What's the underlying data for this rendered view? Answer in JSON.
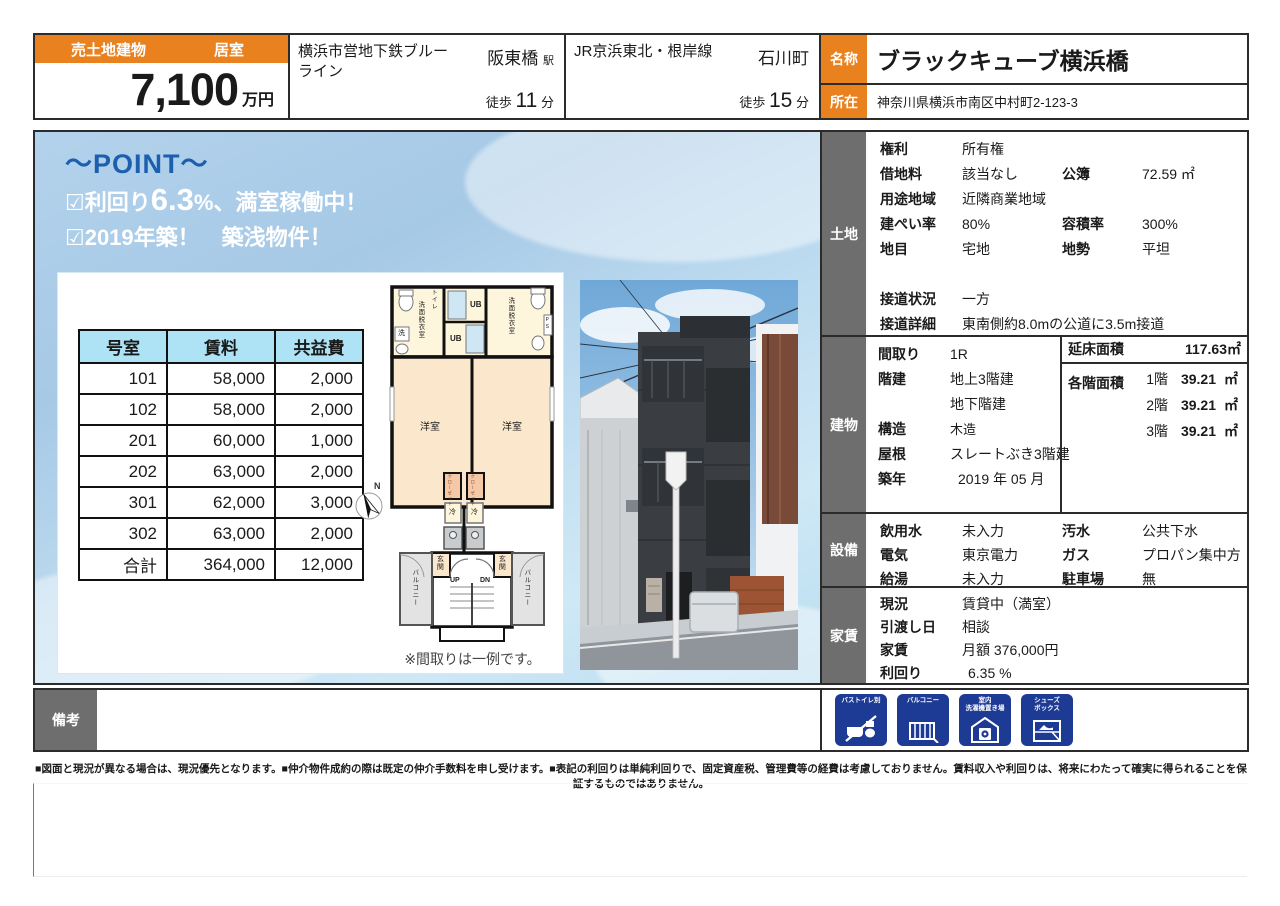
{
  "header": {
    "sale_type": "売土地建物",
    "room_type": "居室",
    "price": "7,100",
    "price_unit": "万円",
    "stations": [
      {
        "line": "横浜市営地下鉄ブルーライン",
        "station": "阪東橋",
        "suffix": "駅",
        "walk": "徒歩",
        "minutes": "11",
        "unit": "分"
      },
      {
        "line": "JR京浜東北・根岸線",
        "station": "石川町",
        "suffix": "",
        "walk": "徒歩",
        "minutes": "15",
        "unit": "分"
      }
    ],
    "name_label": "名称",
    "name": "ブラックキューブ横浜橋",
    "address_label": "所在",
    "address": "神奈川県横浜市南区中村町2-123-3"
  },
  "point": {
    "title": "～POINT～",
    "line1_pre": "☑利回り",
    "line1_big": "6.3",
    "line1_post": "%、満室稼働中！",
    "line2": "☑2019年築！　築浅物件！"
  },
  "rent_table": {
    "headers": [
      "号室",
      "賃料",
      "共益費"
    ],
    "rows": [
      [
        "101",
        "58,000",
        "2,000"
      ],
      [
        "102",
        "58,000",
        "2,000"
      ],
      [
        "201",
        "60,000",
        "1,000"
      ],
      [
        "202",
        "63,000",
        "2,000"
      ],
      [
        "301",
        "62,000",
        "3,000"
      ],
      [
        "302",
        "63,000",
        "2,000"
      ]
    ],
    "total": [
      "合計",
      "364,000",
      "12,000"
    ]
  },
  "floorplan": {
    "labels": {
      "toilet": "トイレ",
      "washroom": "洗面脱衣室",
      "washer": "洗",
      "ub": "UB",
      "ps": "PS",
      "room": "洋室",
      "closet": "クローゼット",
      "fridge": "冷",
      "entrance": "玄関",
      "up": "UP",
      "dn": "DN",
      "balcony": "バルコニー",
      "north": "N"
    },
    "note": "※間取りは一例です。"
  },
  "land": {
    "label": "土地",
    "rights_label": "権利",
    "rights": "所有権",
    "lease_label": "借地料",
    "lease": "該当なし",
    "registry_label": "公簿",
    "registry": "72.59 ㎡",
    "zoning_label": "用途地域",
    "zoning": "近隣商業地域",
    "coverage_label": "建ぺい率",
    "coverage": "80%",
    "far_label": "容積率",
    "far": "300%",
    "category_label": "地目",
    "category": "宅地",
    "terrain_label": "地勢",
    "terrain": "平坦",
    "road_label": "接道状況",
    "road": "一方",
    "road_detail_label": "接道詳細",
    "road_detail": "東南側約8.0mの公道に3.5m接道"
  },
  "building": {
    "label": "建物",
    "layout_label": "間取り",
    "layout": "1R",
    "floors_label": "階建",
    "floors_above": "地上3階建",
    "floors_below": "地下階建",
    "structure_label": "構造",
    "structure": "木造",
    "roof_label": "屋根",
    "roof": "スレートぶき3階建",
    "built_label": "築年",
    "built": "2019 年 05 月",
    "total_area_label": "延床面積",
    "total_area": "117.63㎡",
    "floor_area_label": "各階面積",
    "floor_areas": [
      {
        "floor": "1階",
        "value": "39.21",
        "unit": "㎡"
      },
      {
        "floor": "2階",
        "value": "39.21",
        "unit": "㎡"
      },
      {
        "floor": "3階",
        "value": "39.21",
        "unit": "㎡"
      }
    ]
  },
  "facilities": {
    "label": "設備",
    "water_label": "飲用水",
    "water": "未入力",
    "sewage_label": "汚水",
    "sewage": "公共下水",
    "electric_label": "電気",
    "electric": "東京電力",
    "gas_label": "ガス",
    "gas": "プロパン集中方",
    "hot_water_label": "給湯",
    "hot_water": "未入力",
    "parking_label": "駐車場",
    "parking": "無"
  },
  "rent_status": {
    "label": "家賃",
    "status_label": "現況",
    "status": "賃貸中（満室）",
    "handover_label": "引渡し日",
    "handover": "相談",
    "rent_label": "家賃",
    "rent": "月額 376,000円",
    "yield_label": "利回り",
    "yield": "6.35 %"
  },
  "remarks": {
    "label": "備考"
  },
  "feature_icons": [
    {
      "label": "バストイレ別"
    },
    {
      "label": "バルコニー"
    },
    {
      "label": "室内\n洗濯機置き場"
    },
    {
      "label": "シューズ\nボックス"
    }
  ],
  "disclaimer": "■図面と現況が異なる場合は、現況優先となります。■仲介物件成約の際は既定の仲介手数料を申し受けます。■表記の利回りは単純利回りで、固定資産税、管理費等の経費は考慮しておりません。賃料収入や利回りは、将来にわたって確実に得られることを保証するものではありません。",
  "colors": {
    "accent_orange": "#e8811e",
    "section_gray": "#6e6e6e",
    "table_header_blue": "#aee3f5",
    "point_blue": "#1b5fae",
    "badge_navy": "#1d3a94"
  }
}
